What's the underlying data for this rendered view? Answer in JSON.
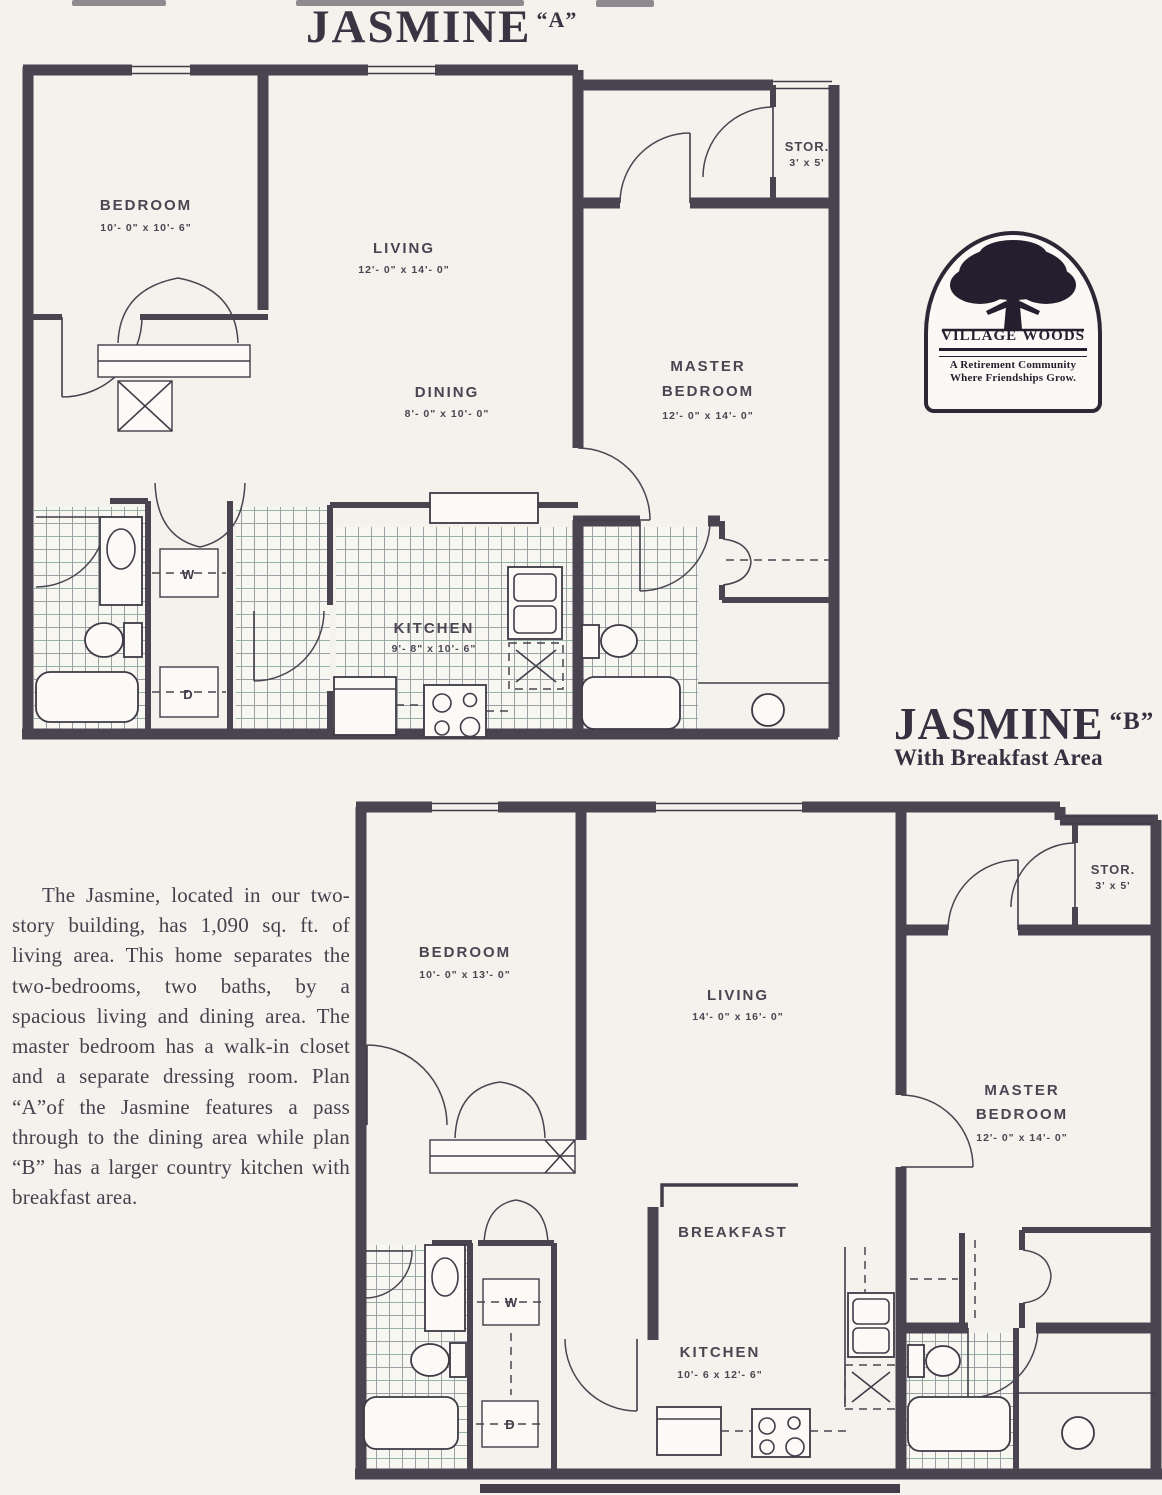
{
  "titles": {
    "plan_a_name": "JASMINE",
    "plan_a_variant": "“A”",
    "plan_b_name": "JASMINE",
    "plan_b_variant": "“B”",
    "plan_b_subtitle": "With Breakfast Area"
  },
  "logo": {
    "name_left": "VILLAGE",
    "name_right": "WOODS",
    "tagline1": "A Retirement Community",
    "tagline2": "Where Friendships Grow."
  },
  "description": {
    "text": "The Jasmine, located in our two-story building, has 1,090 sq. ft. of living area. This home separates the two-bedrooms, two baths, by a spacious living and dining area. The master bedroom has a walk-in closet and a separate dressing room. Plan “A”of the Jasmine features a pass through to the dining area while plan “B” has a larger country kitchen with breakfast area."
  },
  "plan_a": {
    "bedroom_name": "BEDROOM",
    "bedroom_dims": "10'- 0\" x 10'- 6\"",
    "living_name": "LIVING",
    "living_dims": "12'- 0\" x 14'- 0\"",
    "dining_name": "DINING",
    "dining_dims": "8'- 0\" x 10'- 0\"",
    "master_name_line1": "MASTER",
    "master_name_line2": "BEDROOM",
    "master_dims": "12'- 0\" x 14'- 0\"",
    "stor_name": "STOR.",
    "stor_dims": "3' x 5'",
    "kitchen_name": "KITCHEN",
    "kitchen_dims": "9'- 8\" x 10'- 6\"",
    "washer": "W",
    "dryer": "D"
  },
  "plan_b": {
    "bedroom_name": "BEDROOM",
    "bedroom_dims": "10'- 0\" x 13'- 0\"",
    "living_name": "LIVING",
    "living_dims": "14'- 0\" x 16'- 0\"",
    "master_name_line1": "MASTER",
    "master_name_line2": "BEDROOM",
    "master_dims": "12'- 0\" x 14'- 0\"",
    "breakfast_name": "BREAKFAST",
    "kitchen_name": "KITCHEN",
    "kitchen_dims": "10'- 6 x 12'- 6\"",
    "stor_name": "STOR.",
    "stor_dims": "3' x 5'",
    "washer": "W",
    "dryer": "D"
  }
}
